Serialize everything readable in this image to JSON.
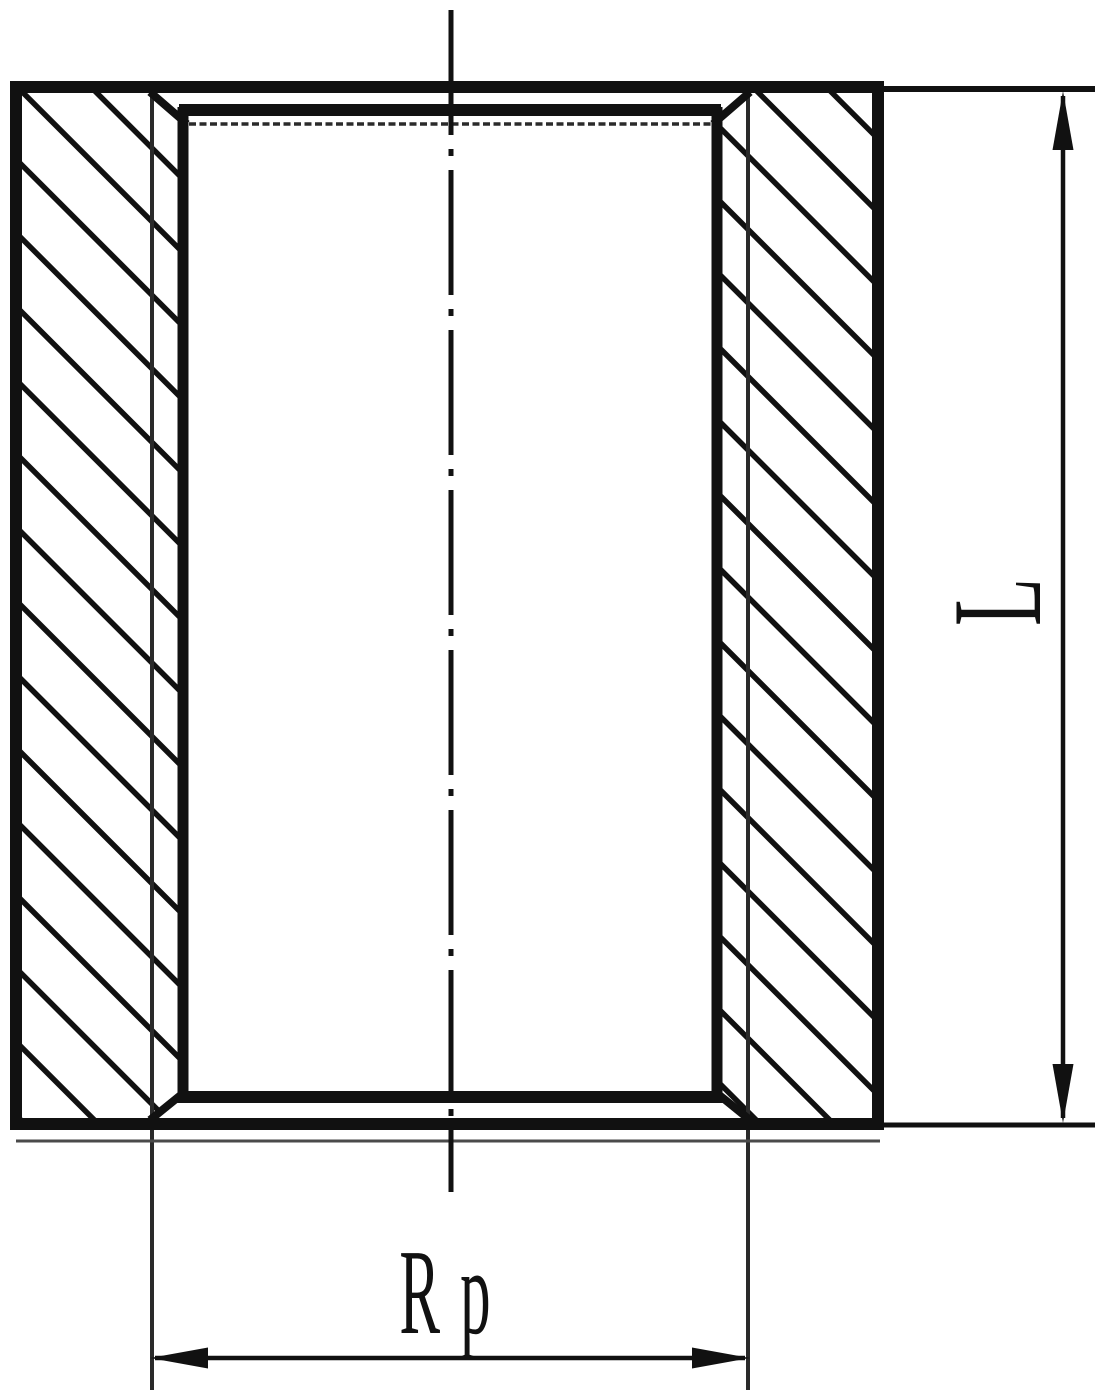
{
  "drawing": {
    "title": "Threaded socket cross-section",
    "view": "full section, vertical axis",
    "part": "pipe socket / coupling with internal Rp thread, chamfered bore ends",
    "dimensions": {
      "length": {
        "label": "L",
        "orientation": "vertical",
        "side": "right"
      },
      "thread": {
        "label": "Rp",
        "orientation": "horizontal",
        "side": "bottom"
      }
    },
    "features": {
      "hatching": "45-degree section hatching on both wall cuts",
      "centerline": "vertical dash-dot axis line",
      "chamfers": "four internal bore chamfers"
    },
    "colors": {
      "line": "#111111",
      "thin_line": "#2a2a2a",
      "artifact_line": "#4a4a4a",
      "background": "#ffffff"
    }
  }
}
